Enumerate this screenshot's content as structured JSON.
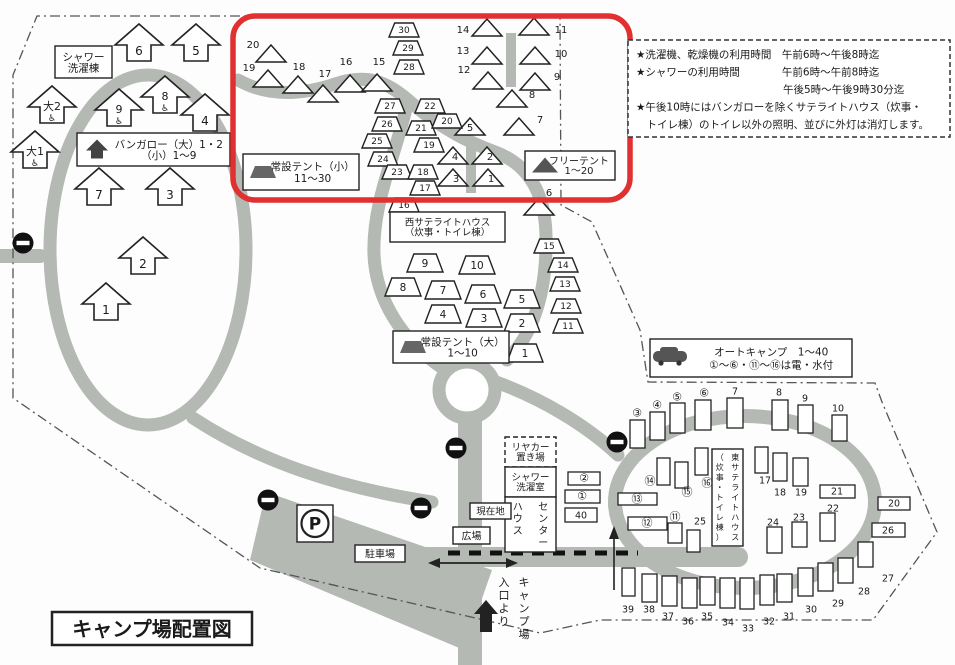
{
  "title": "キャンプ場配置図",
  "colors": {
    "road": "#b4b9b4",
    "highlight_red": "#e03030",
    "ink": "#1a1a1a"
  },
  "info_box": {
    "lines": [
      "★洗濯機、乾燥機の利用時間　午前6時～午後8時迄",
      "★シャワーの利用時間　　　　午前6時～午前8時迄",
      "　　　　　　　　　　　　　　午後5時～午後9時30分迄",
      "★午後10時にはバンガローを除くサテライトハウス（炊事・",
      "　トイレ棟）のトイレ以外の照明、並びに外灯は消灯します。"
    ]
  },
  "legends": [
    {
      "name": "bungalow-legend",
      "icon": "arrow",
      "x": 77,
      "y": 133,
      "w": 153,
      "h": 33,
      "fs": 10.5,
      "lines": [
        "バンガロー（大）1・2",
        "（小）1～9"
      ]
    },
    {
      "name": "small-tent-legend",
      "icon": "trapezoid",
      "x": 243,
      "y": 154,
      "w": 116,
      "h": 36,
      "fs": 10.5,
      "lines": [
        "常設テント（小）",
        "11～30"
      ]
    },
    {
      "name": "free-tent-legend",
      "icon": "triangle",
      "x": 525,
      "y": 151,
      "w": 90,
      "h": 29,
      "fs": 10,
      "lines": [
        "フリーテント",
        "1～20"
      ]
    },
    {
      "name": "large-tent-legend",
      "icon": "trapezoid",
      "x": 393,
      "y": 331,
      "w": 116,
      "h": 32,
      "fs": 10.5,
      "lines": [
        "常設テント（大）",
        "1～10"
      ]
    },
    {
      "name": "auto-camp-legend",
      "icon": "car",
      "x": 650,
      "y": 339,
      "w": 202,
      "h": 38,
      "fs": 10.5,
      "lines": [
        "オートキャンプ　1～40",
        "①～⑥・⑪～⑯は電・水付"
      ]
    }
  ],
  "boxes": [
    {
      "name": "shower-laundry-building-label",
      "x": 55,
      "y": 46,
      "w": 57,
      "h": 32,
      "fs": 10.5,
      "lines": [
        "シャワー",
        "洗濯棟"
      ]
    },
    {
      "name": "west-satellite-house-label",
      "x": 390,
      "y": 212,
      "w": 115,
      "h": 30,
      "fs": 9.5,
      "lines": [
        "西サテライトハウス",
        "（炊事・トイレ棟）"
      ]
    },
    {
      "name": "rear-cart-storage-label",
      "x": 505,
      "y": 437,
      "w": 51,
      "h": 30,
      "fs": 9.5,
      "dashed": true,
      "lines": [
        "リヤカー",
        "置き場"
      ]
    },
    {
      "name": "shower-laundry-room-label",
      "x": 505,
      "y": 467,
      "w": 51,
      "h": 30,
      "fs": 9.5,
      "lines": [
        "シャワー",
        "洗濯室"
      ]
    },
    {
      "name": "center-house-label",
      "x": 505,
      "y": 497,
      "w": 51,
      "h": 55,
      "fs": 10,
      "vcols": [
        "センター",
        "ハウス"
      ]
    },
    {
      "name": "east-satellite-house-label",
      "x": 712,
      "y": 449,
      "w": 31,
      "h": 97,
      "fs": 8,
      "vcols": [
        "東サテライトハウス",
        "（炊事・トイレ棟）"
      ]
    },
    {
      "name": "current-location-label",
      "x": 470,
      "y": 503,
      "w": 41,
      "h": 16,
      "fs": 9.5,
      "lines": [
        "現在地"
      ]
    },
    {
      "name": "plaza-label",
      "x": 453,
      "y": 527,
      "w": 37,
      "h": 17,
      "fs": 10,
      "lines": [
        "広場"
      ]
    },
    {
      "name": "parking-lot-label",
      "x": 355,
      "y": 545,
      "w": 50,
      "h": 17,
      "fs": 10,
      "lines": [
        "駐車場"
      ]
    },
    {
      "name": "parking-symbol",
      "x": 297,
      "y": 505,
      "w": 36,
      "h": 37,
      "fs": 17,
      "circleP": true,
      "lines": [
        "P"
      ]
    },
    {
      "name": "entrance-label",
      "x": 494,
      "y": 572,
      "w": 40,
      "h": 66,
      "fs": 11,
      "noborder": true,
      "vcols": [
        "キャンプ場",
        "入口より"
      ]
    },
    {
      "name": "map-title",
      "x": 52,
      "y": 612,
      "w": 200,
      "h": 33,
      "fs": 20,
      "bold": true,
      "bw": 2.5,
      "lines": [
        "キャンプ場配置図"
      ]
    }
  ],
  "bungalows": [
    [
      "6",
      139,
      45,
      0
    ],
    [
      "5",
      196,
      45,
      0
    ],
    [
      "大2",
      52,
      107,
      1
    ],
    [
      "9",
      119,
      110,
      1
    ],
    [
      "8",
      165,
      97,
      1
    ],
    [
      "4",
      205,
      115,
      0
    ],
    [
      "大1",
      35,
      152,
      1
    ],
    [
      "7",
      99,
      189,
      0
    ],
    [
      "3",
      170,
      189,
      0
    ],
    [
      "2",
      143,
      258,
      0
    ],
    [
      "1",
      106,
      304,
      0
    ]
  ],
  "free_tents": [
    [
      "20",
      271,
      54,
      253,
      48
    ],
    [
      "19",
      268,
      79,
      249,
      71
    ],
    [
      "18",
      298,
      85,
      299,
      70
    ],
    [
      "17",
      323,
      94,
      325,
      77
    ],
    [
      "16",
      350,
      84,
      346,
      65
    ],
    [
      "15",
      377,
      83,
      379,
      65
    ],
    [
      "5",
      470,
      127,
      470,
      131
    ],
    [
      "4",
      453,
      156,
      455,
      160
    ],
    [
      "2",
      487,
      156,
      490,
      160
    ],
    [
      "3",
      453,
      178,
      456,
      182
    ],
    [
      "1",
      488,
      178,
      491,
      182
    ],
    [
      "14",
      487,
      28,
      463,
      33
    ],
    [
      "11",
      534,
      27,
      561,
      33
    ],
    [
      "13",
      487,
      56,
      463,
      54
    ],
    [
      "10",
      535,
      56,
      561,
      57
    ],
    [
      "12",
      488,
      81,
      464,
      73
    ],
    [
      "9",
      535,
      82,
      557,
      80
    ],
    [
      "8",
      512,
      99,
      532,
      98
    ],
    [
      "7",
      519,
      127,
      540,
      123
    ],
    [
      "6",
      539,
      207,
      549,
      196
    ]
  ],
  "small_tents": [
    [
      "30",
      404,
      30
    ],
    [
      "29",
      408,
      48
    ],
    [
      "28",
      409,
      67
    ],
    [
      "27",
      390,
      106
    ],
    [
      "22",
      430,
      106
    ],
    [
      "26",
      387,
      124
    ],
    [
      "21",
      421,
      128
    ],
    [
      "20",
      447,
      121
    ],
    [
      "25",
      377,
      141
    ],
    [
      "19",
      429,
      145
    ],
    [
      "24",
      383,
      159
    ],
    [
      "23",
      397,
      172
    ],
    [
      "18",
      423,
      172
    ],
    [
      "17",
      425,
      188
    ],
    [
      "16",
      404,
      205
    ],
    [
      "15",
      549,
      246
    ],
    [
      "14",
      563,
      265
    ],
    [
      "13",
      565,
      284
    ],
    [
      "12",
      566,
      306
    ],
    [
      "11",
      568,
      326
    ]
  ],
  "large_tents": [
    [
      "9",
      425,
      263
    ],
    [
      "10",
      477,
      265
    ],
    [
      "8",
      403,
      287
    ],
    [
      "7",
      443,
      290
    ],
    [
      "6",
      483,
      294
    ],
    [
      "5",
      522,
      299
    ],
    [
      "4",
      443,
      314
    ],
    [
      "3",
      484,
      318
    ],
    [
      "2",
      522,
      323
    ],
    [
      "1",
      525,
      353
    ]
  ],
  "auto_sites": [
    [
      "③",
      630,
      420,
      15,
      28,
      637,
      413,
      0
    ],
    [
      "④",
      650,
      412,
      15,
      28,
      657,
      405,
      0
    ],
    [
      "⑤",
      670,
      403,
      15,
      30,
      677,
      397,
      0
    ],
    [
      "⑥",
      695,
      400,
      16,
      30,
      704,
      393,
      0
    ],
    [
      "7",
      727,
      398,
      16,
      30,
      735,
      391,
      0
    ],
    [
      "8",
      772,
      400,
      16,
      30,
      779,
      392,
      0
    ],
    [
      "9",
      798,
      405,
      15,
      28,
      805,
      398,
      0
    ],
    [
      "10",
      832,
      415,
      15,
      26,
      838,
      408,
      0
    ],
    [
      "②",
      568,
      472,
      32,
      13,
      584,
      478,
      1
    ],
    [
      "①",
      565,
      490,
      35,
      13,
      582,
      496,
      1
    ],
    [
      "40",
      565,
      508,
      32,
      14,
      581,
      515,
      1
    ],
    [
      "⑭",
      657,
      458,
      13,
      27,
      650,
      481,
      0
    ],
    [
      "⑮",
      675,
      462,
      13,
      26,
      687,
      492,
      0
    ],
    [
      "⑯",
      695,
      448,
      13,
      27,
      707,
      483,
      0
    ],
    [
      "⑬",
      618,
      493,
      39,
      12,
      637,
      499,
      1
    ],
    [
      "⑫",
      628,
      517,
      39,
      13,
      647,
      523,
      1
    ],
    [
      "⑪",
      668,
      523,
      14,
      20,
      675,
      517,
      0
    ],
    [
      "25",
      687,
      530,
      13,
      22,
      700,
      521,
      0
    ],
    [
      "17",
      755,
      447,
      13,
      26,
      765,
      480,
      0
    ],
    [
      "18",
      773,
      453,
      14,
      28,
      780,
      492,
      0
    ],
    [
      "19",
      793,
      458,
      15,
      28,
      801,
      492,
      0
    ],
    [
      "21",
      820,
      485,
      35,
      13,
      837,
      491,
      1
    ],
    [
      "20",
      878,
      497,
      32,
      13,
      894,
      503,
      1
    ],
    [
      "26",
      872,
      523,
      33,
      14,
      888,
      530,
      1
    ],
    [
      "22",
      820,
      513,
      15,
      28,
      833,
      508,
      0
    ],
    [
      "23",
      792,
      522,
      15,
      25,
      799,
      517,
      0
    ],
    [
      "24",
      767,
      527,
      15,
      26,
      773,
      522,
      0
    ],
    [
      "27",
      858,
      542,
      15,
      25,
      888,
      578,
      0
    ],
    [
      "28",
      838,
      558,
      15,
      25,
      864,
      591,
      0
    ],
    [
      "29",
      818,
      563,
      15,
      28,
      838,
      603,
      0
    ],
    [
      "30",
      798,
      568,
      15,
      28,
      811,
      609,
      0
    ],
    [
      "31",
      777,
      574,
      15,
      28,
      789,
      616,
      0
    ],
    [
      "32",
      760,
      575,
      14,
      30,
      769,
      621,
      0
    ],
    [
      "33",
      740,
      578,
      14,
      31,
      748,
      628,
      0
    ],
    [
      "34",
      720,
      578,
      15,
      30,
      728,
      622,
      0
    ],
    [
      "35",
      700,
      577,
      15,
      28,
      707,
      616,
      0
    ],
    [
      "36",
      682,
      578,
      15,
      30,
      688,
      621,
      0
    ],
    [
      "37",
      662,
      576,
      15,
      30,
      668,
      616,
      0
    ],
    [
      "38",
      642,
      574,
      15,
      28,
      649,
      609,
      0
    ],
    [
      "39",
      622,
      568,
      13,
      28,
      628,
      609,
      0
    ]
  ],
  "no_entry_signs": [
    [
      23,
      243
    ],
    [
      268,
      500
    ],
    [
      421,
      508
    ],
    [
      456,
      448
    ],
    [
      617,
      442
    ]
  ]
}
